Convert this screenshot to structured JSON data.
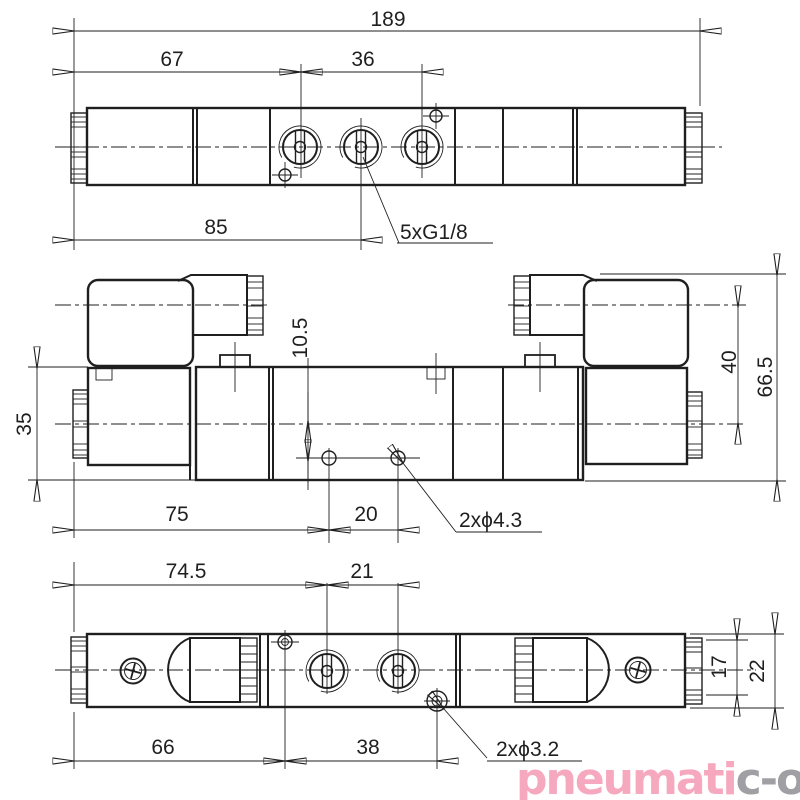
{
  "drawing": {
    "title": "pneumatic solenoid valve dimensional drawing (3 views)",
    "colors": {
      "line": "#1f1f1f",
      "logo_pink": "#f5a8be",
      "logo_gray": "#a0a0a4"
    },
    "top_view": {
      "dims": {
        "overall_length": "189",
        "left_to_port1": "67",
        "port1_to_port3": "36",
        "left_to_port2": "85"
      },
      "port_thread_label": "5xG1/8"
    },
    "front_view": {
      "dims": {
        "body_height": "35",
        "axis_to_mount_holes": "10.5",
        "body_axis_to_coil_axis": "40",
        "overall_height": "66.5",
        "left_to_hole1": "75",
        "hole_spacing": "20"
      },
      "mount_hole_label": "2xϕ4.3"
    },
    "bottom_view": {
      "dims": {
        "left_to_port1": "74.5",
        "port_spacing": "21",
        "left_to_pilot_hole": "66",
        "pilot_hole_spacing": "38",
        "end_face_height": "17",
        "body_height": "22"
      },
      "pilot_hole_label": "2xϕ3.2"
    },
    "logo": {
      "pink": "pneumati",
      "gray": "c-o",
      "reg": "®"
    }
  }
}
